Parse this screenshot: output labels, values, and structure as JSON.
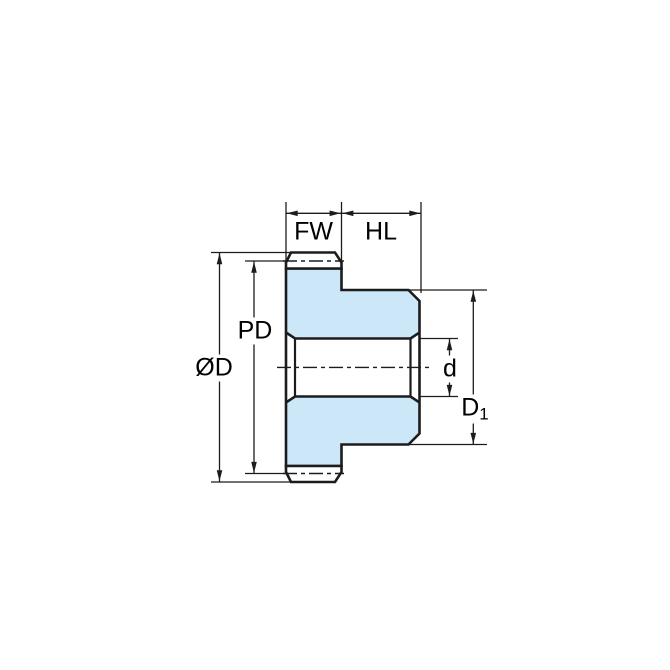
{
  "diagram": {
    "type": "technical-drawing",
    "subject": "spur gear side cross-section with dimension callouts",
    "dimension_labels": {
      "fw": "FW",
      "hl": "HL",
      "pd": "PD",
      "od": "ØD",
      "d": "d",
      "d1_base": "D",
      "d1_sub": "1"
    },
    "colors": {
      "gear_fill": "#cbe7f8",
      "line": "#1c1c1c",
      "background": "#ffffff"
    }
  }
}
